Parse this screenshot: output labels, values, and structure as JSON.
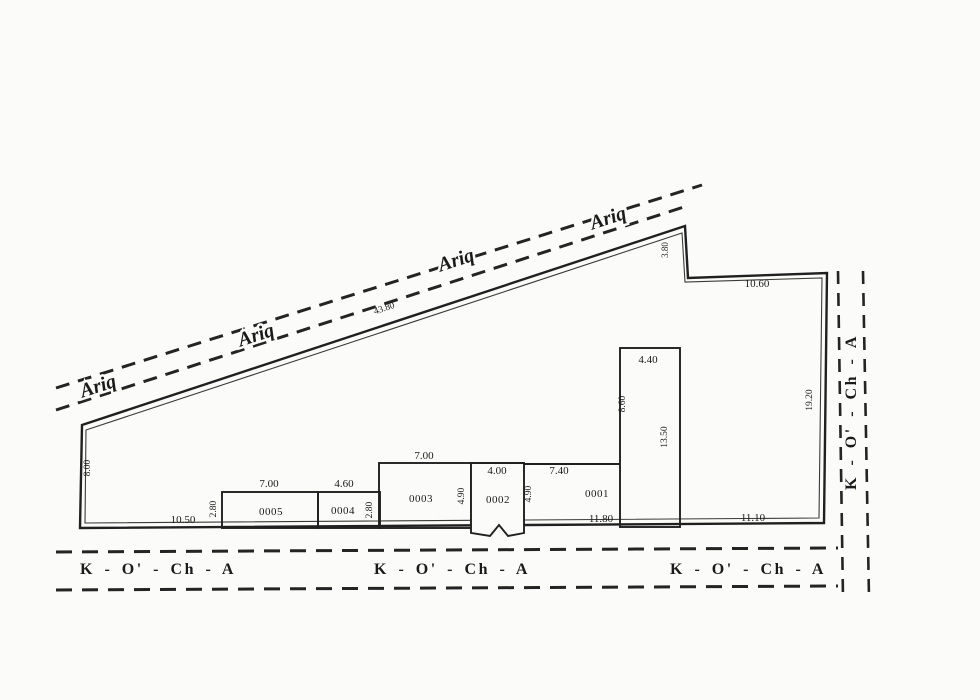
{
  "colors": {
    "ink": "#242424",
    "paper": "#fbfbf9"
  },
  "canal": {
    "label": "Ariq"
  },
  "street": {
    "label": "K  -  O'  -  Ch  -  A"
  },
  "parcel": {
    "edge_dimensions": {
      "left": "8.00",
      "top": "43.80",
      "top_step": "3.80",
      "top_right": "10.60",
      "right": "19.20",
      "bottom_left": "10.50",
      "bottom_right": "11.10"
    }
  },
  "plots": [
    {
      "id": "0005",
      "width": "7.00",
      "depth": "2.80"
    },
    {
      "id": "0004",
      "width": "4.60",
      "depth": "2.80"
    },
    {
      "id": "0003",
      "width": "7.00",
      "depth": "4.90"
    },
    {
      "id": "0002",
      "width": "4.00",
      "depth": "4.90"
    },
    {
      "id": "0001",
      "width": "7.40",
      "bottom_width": "11.80"
    }
  ],
  "extension": {
    "top": "4.40",
    "left_side": "8.60",
    "right_side": "13.50"
  }
}
